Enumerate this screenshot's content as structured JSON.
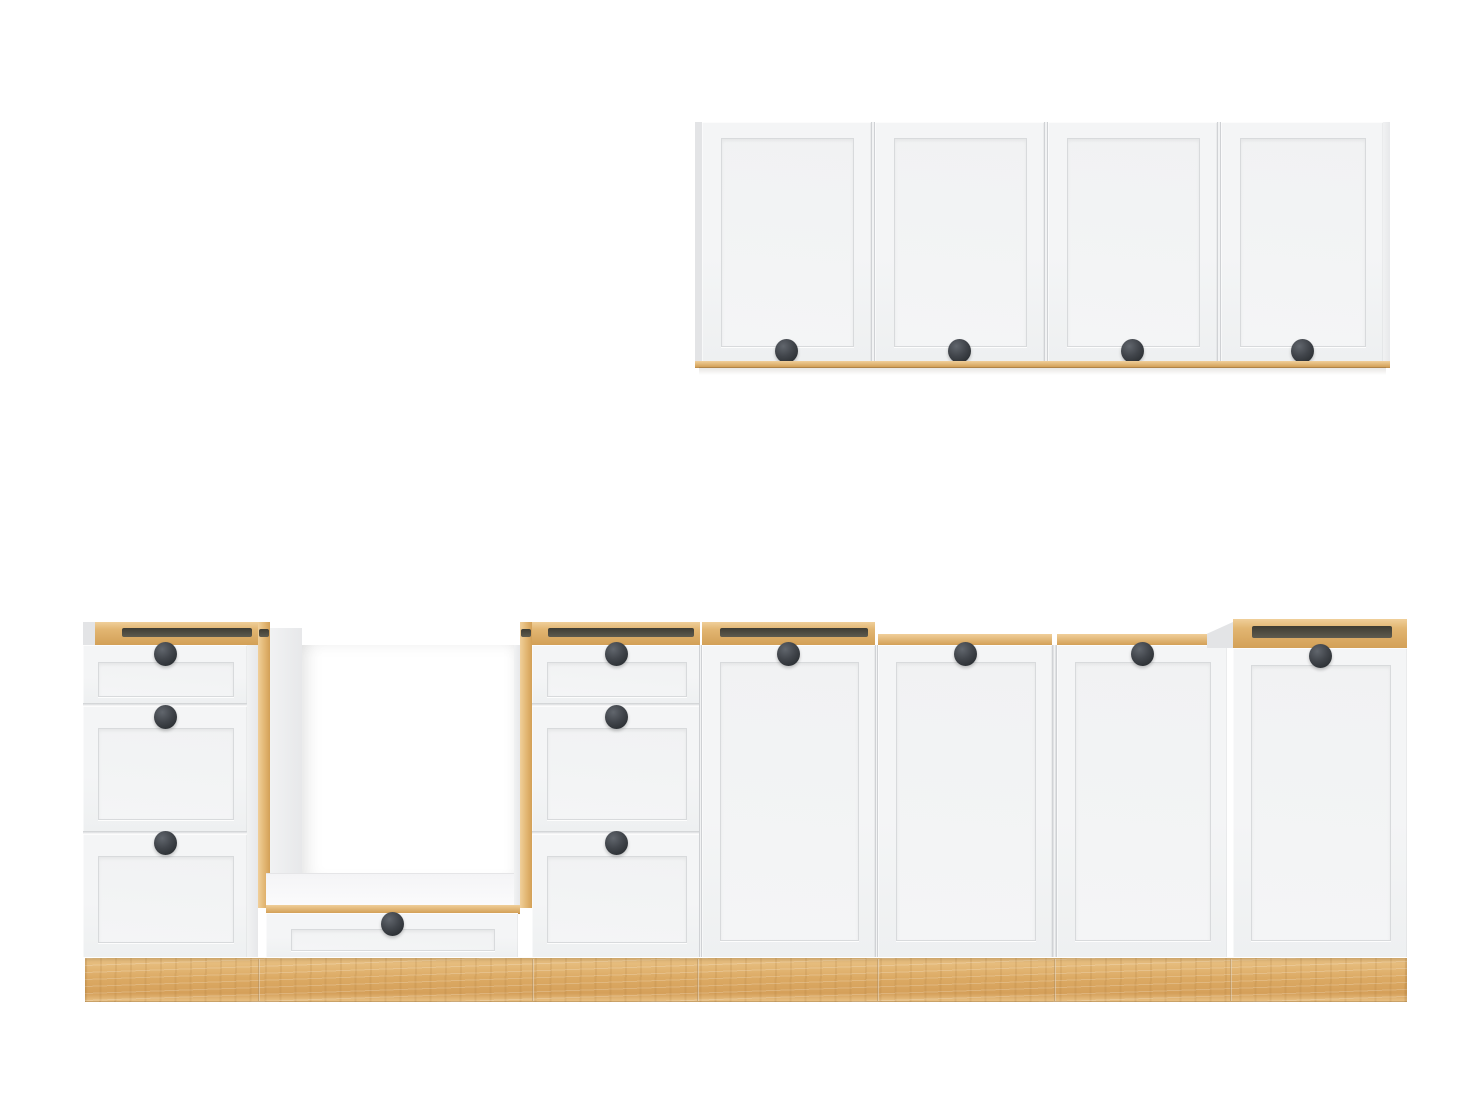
{
  "meta": {
    "subject": "kitchen cabinet set, white shaker fronts with oak carcass edges and oak plinth, no text visible"
  },
  "colors": {
    "bg": "#ffffff",
    "face": "#f4f5f6",
    "face_dark": "#eef0f1",
    "panel_line": "#d8dadc",
    "panel_fill": "#f1f2f3",
    "wood_hi": "#f0cf9a",
    "wood_mid": "#e2b672",
    "wood_lo": "#d3a057",
    "wood_edge_dk": "#c08f4d",
    "slot_dk": "#3f3d33",
    "slot_md": "#5e5b4f",
    "knob_hi": "#61666d",
    "knob_md": "#41454b",
    "knob_dk": "#2c3034",
    "side_hi": "#f1f2f3",
    "side_lo": "#e7e8ea",
    "sliver": "#e3e4e6",
    "plinth_hi": "#eac386",
    "plinth_md": "#dcaa64",
    "plinth_lo": "#d5a05a"
  },
  "knob": {
    "w": 23,
    "h": 24
  },
  "wall_cabinet": {
    "x": 695,
    "y": 122,
    "w": 695,
    "h": 239,
    "left_edge_w": 7,
    "doors": [
      {
        "x": 702,
        "w": 169
      },
      {
        "x": 875,
        "w": 169
      },
      {
        "x": 1048,
        "w": 169
      },
      {
        "x": 1221,
        "w": 162
      }
    ],
    "panel_inset": {
      "s": 19,
      "t": 16,
      "b": 16
    },
    "knob_y": 351,
    "right_panel": {
      "x": 1383,
      "w": 7
    },
    "wood_strip": {
      "y": 361,
      "h": 6
    },
    "shadow_h": 8
  },
  "base": {
    "top_y": 622,
    "top_h": 23,
    "front_y": 645,
    "front_h": 312,
    "strip_y": 634,
    "strip_h": 11,
    "door_knob_y": 654,
    "door_panel": {
      "s": 18,
      "t": 17,
      "b": 18
    },
    "drawer_rows": [
      {
        "y": 645,
        "h": 58,
        "knob_y": 654,
        "panel": {
          "t": 17,
          "b": 8,
          "s": 15
        }
      },
      {
        "y": 706,
        "h": 125,
        "knob_y": 717,
        "panel": {
          "t": 22,
          "b": 13,
          "s": 15
        }
      },
      {
        "y": 834,
        "h": 123,
        "knob_y": 843,
        "panel": {
          "t": 22,
          "b": 16,
          "s": 15
        }
      }
    ],
    "units": [
      {
        "id": "drawer-unit-left",
        "type": "drawers",
        "front_x": 83,
        "front_w": 164,
        "band": {
          "x": 95,
          "w": 163
        },
        "slot": {
          "x": 122,
          "w": 130
        },
        "left_sliver": {
          "x": 83,
          "w": 12
        },
        "side": {
          "x": 247,
          "w": 11
        },
        "knob_x": 165
      },
      {
        "id": "oven-housing",
        "type": "oven",
        "left_edge": {
          "x": 258,
          "w": 12,
          "y": 622,
          "h": 286
        },
        "left_slot": {
          "x": 259,
          "w": 10,
          "y": 629,
          "h": 8
        },
        "left_face": {
          "x": 270,
          "w": 32,
          "y": 628,
          "h": 280
        },
        "niche": {
          "x": 302,
          "w": 212,
          "y": 645,
          "h": 228
        },
        "right_face": {
          "x": 514,
          "w": 6,
          "y": 645,
          "h": 260
        },
        "right_edge": {
          "x": 520,
          "w": 12,
          "y": 622,
          "h": 286
        },
        "right_slot": {
          "x": 521,
          "w": 10,
          "y": 629,
          "h": 8
        },
        "floor": {
          "x": 266,
          "w": 254,
          "y": 873,
          "h": 32
        },
        "floor_edge": {
          "y": 905,
          "h": 8
        },
        "drawer": {
          "x": 266,
          "w": 252,
          "y": 913,
          "h": 44,
          "knob_x": 392,
          "knob_y": 924,
          "panel": {
            "t": 16,
            "b": 8,
            "s": 25
          }
        }
      },
      {
        "id": "drawer-unit-mid",
        "type": "drawers",
        "front_x": 532,
        "front_w": 168,
        "band": {
          "x": 532,
          "w": 168
        },
        "slot": {
          "x": 548,
          "w": 146
        },
        "knob_x": 616
      },
      {
        "id": "base-door-1",
        "type": "door",
        "x": 702,
        "w": 173,
        "top": "open",
        "slot": {
          "x": 720,
          "w": 148
        },
        "knob_x": 788
      },
      {
        "id": "base-door-2",
        "type": "door",
        "x": 878,
        "w": 174,
        "top": "strip",
        "knob_x": 965
      },
      {
        "id": "base-door-3",
        "type": "door",
        "x": 1057,
        "w": 170,
        "top": "strip",
        "knob_x": 1142
      },
      {
        "id": "base-door-right",
        "type": "door",
        "x": 1233,
        "w": 174,
        "top": "raised",
        "door_y": 648,
        "slot": {
          "x": 1252,
          "w": 140
        },
        "left_sliver": {
          "x": 1207,
          "w": 26
        },
        "knob_x": 1320,
        "knob_y": 656
      }
    ],
    "gaps_v": [
      {
        "x": 699,
        "w": 3
      },
      {
        "x": 875,
        "w": 3
      },
      {
        "x": 1052,
        "w": 5
      }
    ]
  },
  "plinth": {
    "x": 85,
    "w": 1322,
    "y": 958,
    "h": 44,
    "seams": [
      258,
      532,
      697,
      877,
      1054,
      1230
    ]
  }
}
